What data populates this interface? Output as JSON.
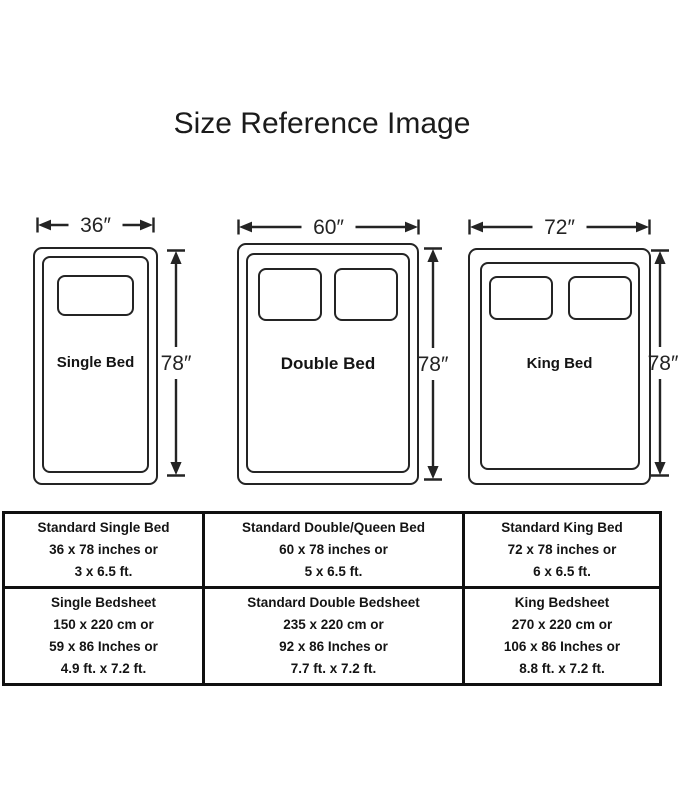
{
  "title": "Size Reference Image",
  "colors": {
    "ink": "#242424",
    "table_border": "#101010",
    "background": "#ffffff"
  },
  "beds": [
    {
      "name": "Single Bed",
      "width_label": "36″",
      "height_label": "78″",
      "pillow_count": 1
    },
    {
      "name": "Double Bed",
      "width_label": "60″",
      "height_label": "78″",
      "pillow_count": 2
    },
    {
      "name": "King Bed",
      "width_label": "72″",
      "height_label": "78″",
      "pillow_count": 2
    }
  ],
  "table": {
    "rows": [
      {
        "cells": [
          {
            "lines": [
              "Standard Single Bed",
              "36 x 78 inches or",
              "3 x 6.5 ft."
            ]
          },
          {
            "lines": [
              "Standard Double/Queen Bed",
              "60 x 78 inches or",
              "5 x 6.5 ft."
            ]
          },
          {
            "lines": [
              "Standard King Bed",
              "72 x 78 inches or",
              "6 x 6.5 ft."
            ]
          }
        ]
      },
      {
        "cells": [
          {
            "lines": [
              "Single Bedsheet",
              "150 x 220 cm or",
              "59 x 86 Inches or",
              "4.9 ft. x 7.2 ft."
            ]
          },
          {
            "lines": [
              "Standard Double Bedsheet",
              "235 x 220 cm or",
              "92 x 86 Inches or",
              "7.7 ft. x 7.2 ft."
            ]
          },
          {
            "lines": [
              "King Bedsheet",
              "270 x 220 cm or",
              "106 x 86 Inches or",
              "8.8 ft. x 7.2 ft."
            ]
          }
        ]
      }
    ]
  }
}
